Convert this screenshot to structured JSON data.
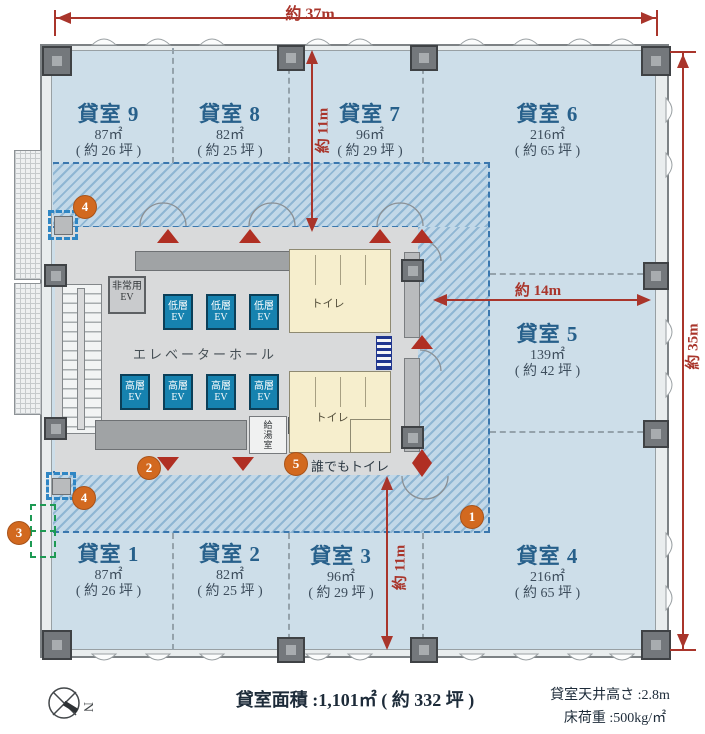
{
  "dimensions": {
    "width_top": "約 37m",
    "height_right": "約 35m",
    "depth_upper": "約 11m",
    "depth_lower": "約 11m",
    "width_mid": "約 14m"
  },
  "rooms": [
    {
      "name": "貸室 9",
      "area": "87㎡",
      "tsubo": "( 約 26 坪 )"
    },
    {
      "name": "貸室 8",
      "area": "82㎡",
      "tsubo": "( 約 25 坪 )"
    },
    {
      "name": "貸室 7",
      "area": "96㎡",
      "tsubo": "( 約 29 坪 )"
    },
    {
      "name": "貸室 6",
      "area": "216㎡",
      "tsubo": "( 約 65 坪 )"
    },
    {
      "name": "貸室 5",
      "area": "139㎡",
      "tsubo": "( 約 42 坪 )"
    },
    {
      "name": "貸室 4",
      "area": "216㎡",
      "tsubo": "( 約 65 坪 )"
    },
    {
      "name": "貸室 3",
      "area": "96㎡",
      "tsubo": "( 約 29 坪 )"
    },
    {
      "name": "貸室 2",
      "area": "82㎡",
      "tsubo": "( 約 25 坪 )"
    },
    {
      "name": "貸室 1",
      "area": "87㎡",
      "tsubo": "( 約 26 坪 )"
    }
  ],
  "core": {
    "emergency_ev": "非常用EV",
    "low_ev": "低層EV",
    "high_ev": "高層EV",
    "elevator_hall": "エレベーターホール",
    "toilet": "トイレ",
    "kitchenette": "給湯室",
    "accessible_toilet": "誰でもトイレ"
  },
  "markers": {
    "m1": "1",
    "m2": "2",
    "m3": "3",
    "m4": "4",
    "m5": "5"
  },
  "footer": {
    "total_area": "貸室面積 :1,101㎡ ( 約 332 坪 )",
    "ceiling_height": "貸室天井高さ :2.8m",
    "floor_load": "床荷重 :500kg/㎡",
    "compass_north": "N"
  },
  "colors": {
    "accent_orange": "#d2691f",
    "dimension_red": "#a9352b",
    "room_label_blue": "#27608b",
    "ev_teal": "#1682af",
    "hatch_blue": "#8fb6d3",
    "room_fill": "#cddee9"
  }
}
